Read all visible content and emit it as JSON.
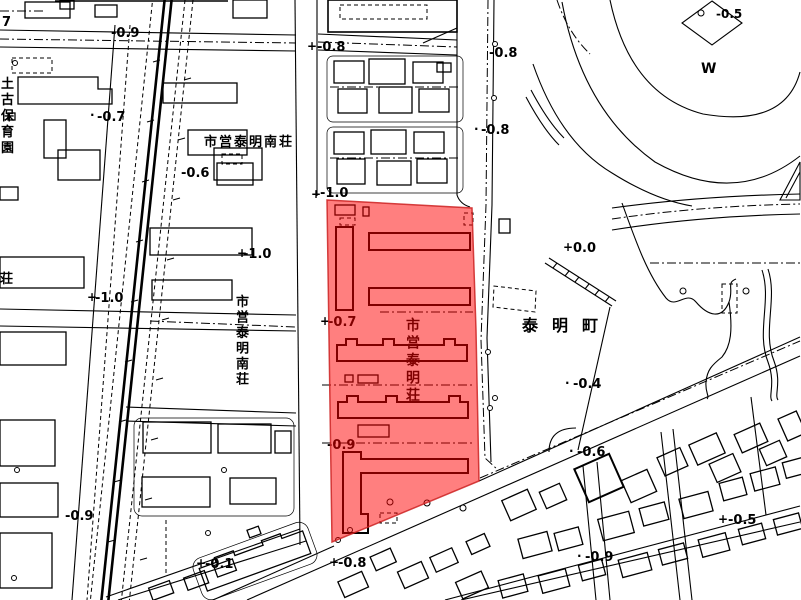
{
  "map": {
    "background_color": "#ffffff",
    "linework_color": "#000000",
    "highlight": {
      "name": "municipal-taimei-housing-site",
      "fill_color": "rgba(255,0,0,0.5)",
      "edge_color": "rgba(204,34,34,0.85)"
    },
    "place_labels": [
      {
        "text": "土古保育園",
        "x": 1,
        "y": 75,
        "vertical": true,
        "lh": 16,
        "s": 13
      },
      {
        "text": "市営泰明南荘",
        "x": 204,
        "y": 146,
        "s": 13,
        "ls": 2
      },
      {
        "text": "荘",
        "x": 0,
        "y": 283,
        "s": 13
      },
      {
        "text": "市営泰明南荘",
        "x": 236,
        "y": 293,
        "vertical": true,
        "lh": 15.5,
        "s": 13
      },
      {
        "text": "市営泰明荘",
        "x": 406,
        "y": 316,
        "vertical": true,
        "lh": 17.5,
        "s": 14
      },
      {
        "text": "泰明町",
        "x": 522,
        "y": 331,
        "s": 16,
        "ls": 14
      },
      {
        "text": "W",
        "x": 701,
        "y": 73,
        "s": 14
      }
    ],
    "elevation_labels": [
      {
        "text": "7",
        "x": 2,
        "y": 26
      },
      {
        "text": "-0.9",
        "x": 111,
        "y": 37
      },
      {
        "text": "-0.7",
        "x": 97,
        "y": 121
      },
      {
        "text": "-0.6",
        "x": 181,
        "y": 177
      },
      {
        "text": "-0.8",
        "x": 317,
        "y": 51
      },
      {
        "text": "-0.8",
        "x": 489,
        "y": 57
      },
      {
        "text": "-0.8",
        "x": 481,
        "y": 134
      },
      {
        "text": "-1.0",
        "x": 320,
        "y": 197
      },
      {
        "text": "-0.5",
        "x": 716,
        "y": 18,
        "s": 12
      },
      {
        "text": "-1.0",
        "x": 243,
        "y": 258
      },
      {
        "text": "-1.0",
        "x": 95,
        "y": 302
      },
      {
        "text": "-0.7",
        "x": 328,
        "y": 326
      },
      {
        "text": "-0.9",
        "x": 327,
        "y": 449
      },
      {
        "text": "0.0",
        "x": 573,
        "y": 252
      },
      {
        "text": "-0.4",
        "x": 573,
        "y": 388
      },
      {
        "text": "-0.1",
        "x": 205,
        "y": 568
      },
      {
        "text": "-0.9",
        "x": 65,
        "y": 520
      },
      {
        "text": "-0.8",
        "x": 338,
        "y": 567
      },
      {
        "text": "-0.6",
        "x": 577,
        "y": 456
      },
      {
        "text": "-0.5",
        "x": 728,
        "y": 524
      },
      {
        "text": "-0.9",
        "x": 585,
        "y": 561
      }
    ],
    "survey_markers": [
      {
        "text": "+",
        "x": 307,
        "y": 50,
        "s": 12
      },
      {
        "text": "+",
        "x": 311,
        "y": 198,
        "s": 12
      },
      {
        "text": "+",
        "x": 87,
        "y": 301,
        "s": 12
      },
      {
        "text": "+",
        "x": 320,
        "y": 325,
        "s": 12
      },
      {
        "text": "+",
        "x": 563,
        "y": 251,
        "s": 12
      },
      {
        "text": "+",
        "x": 196,
        "y": 567,
        "s": 12
      },
      {
        "text": "+",
        "x": 329,
        "y": 566,
        "s": 12
      },
      {
        "text": "+",
        "x": 718,
        "y": 523,
        "s": 12
      },
      {
        "text": "+",
        "x": 237,
        "y": 257,
        "s": 12
      },
      {
        "text": "·",
        "x": 90,
        "y": 119,
        "s": 12
      },
      {
        "text": "·",
        "x": 474,
        "y": 133,
        "s": 12
      },
      {
        "text": "·",
        "x": 565,
        "y": 387,
        "s": 12
      },
      {
        "text": "·",
        "x": 569,
        "y": 455,
        "s": 12
      },
      {
        "text": "·",
        "x": 577,
        "y": 560,
        "s": 12
      }
    ]
  }
}
